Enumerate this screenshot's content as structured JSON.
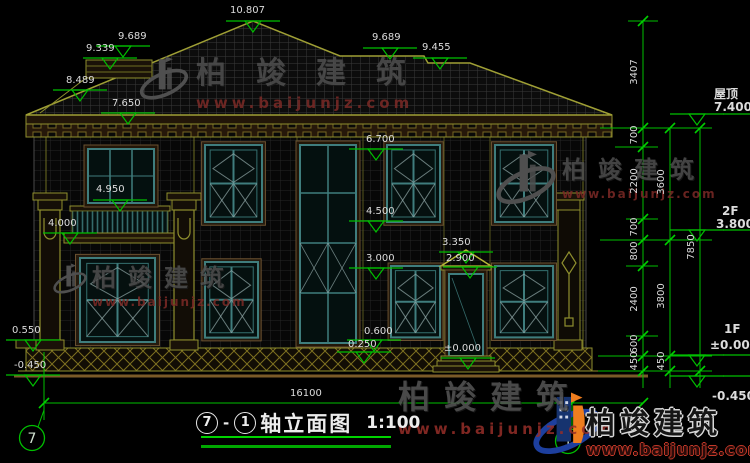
{
  "drawing_title": {
    "axis_start": "7",
    "dash": "-",
    "axis_end": "1",
    "name": "轴立面图",
    "scale": "1:100"
  },
  "axes": {
    "left_bubble": "7",
    "right_bubble": "1"
  },
  "elevation_labels": {
    "ridge_main": "10.807",
    "roof_left_upper": "9.689",
    "roof_left_ridge": "9.339",
    "roof_left_lower": "8.489",
    "gutter": "7.650",
    "roof_right_ridge": "9.689",
    "roof_right_lower": "9.455",
    "win2f_head": "6.700",
    "balcony_door_sill": "4.950",
    "win2f_sill": "4.500",
    "balcony_floor": "4.000",
    "pediment_top": "3.350",
    "win1f_head": "3.000",
    "door_head": "2.900",
    "win1f_sill": "0.600",
    "porch_slab": "0.550",
    "plinth_top": "0.250",
    "threshold": "±0.000",
    "ground_left": "-0.450"
  },
  "right_levels": {
    "roof_label": "屋顶",
    "roof": "7.400",
    "f2_label": "2F",
    "f2": "3.800",
    "f1_label": "1F",
    "f1": "±0.000",
    "ground": "-0.450"
  },
  "dim_chains": {
    "inner": [
      "3407",
      "700",
      "2200",
      "700",
      "800",
      "2400",
      "600",
      "450"
    ],
    "middle": [
      "3600",
      "3800",
      "450"
    ],
    "outer": [
      "7850"
    ],
    "total_width": "16100"
  },
  "watermark": {
    "name": "柏竣建筑",
    "url": "www.baijunjz.com"
  },
  "logo": {
    "name": "柏竣建筑",
    "url": "www.baijunjz.com"
  }
}
